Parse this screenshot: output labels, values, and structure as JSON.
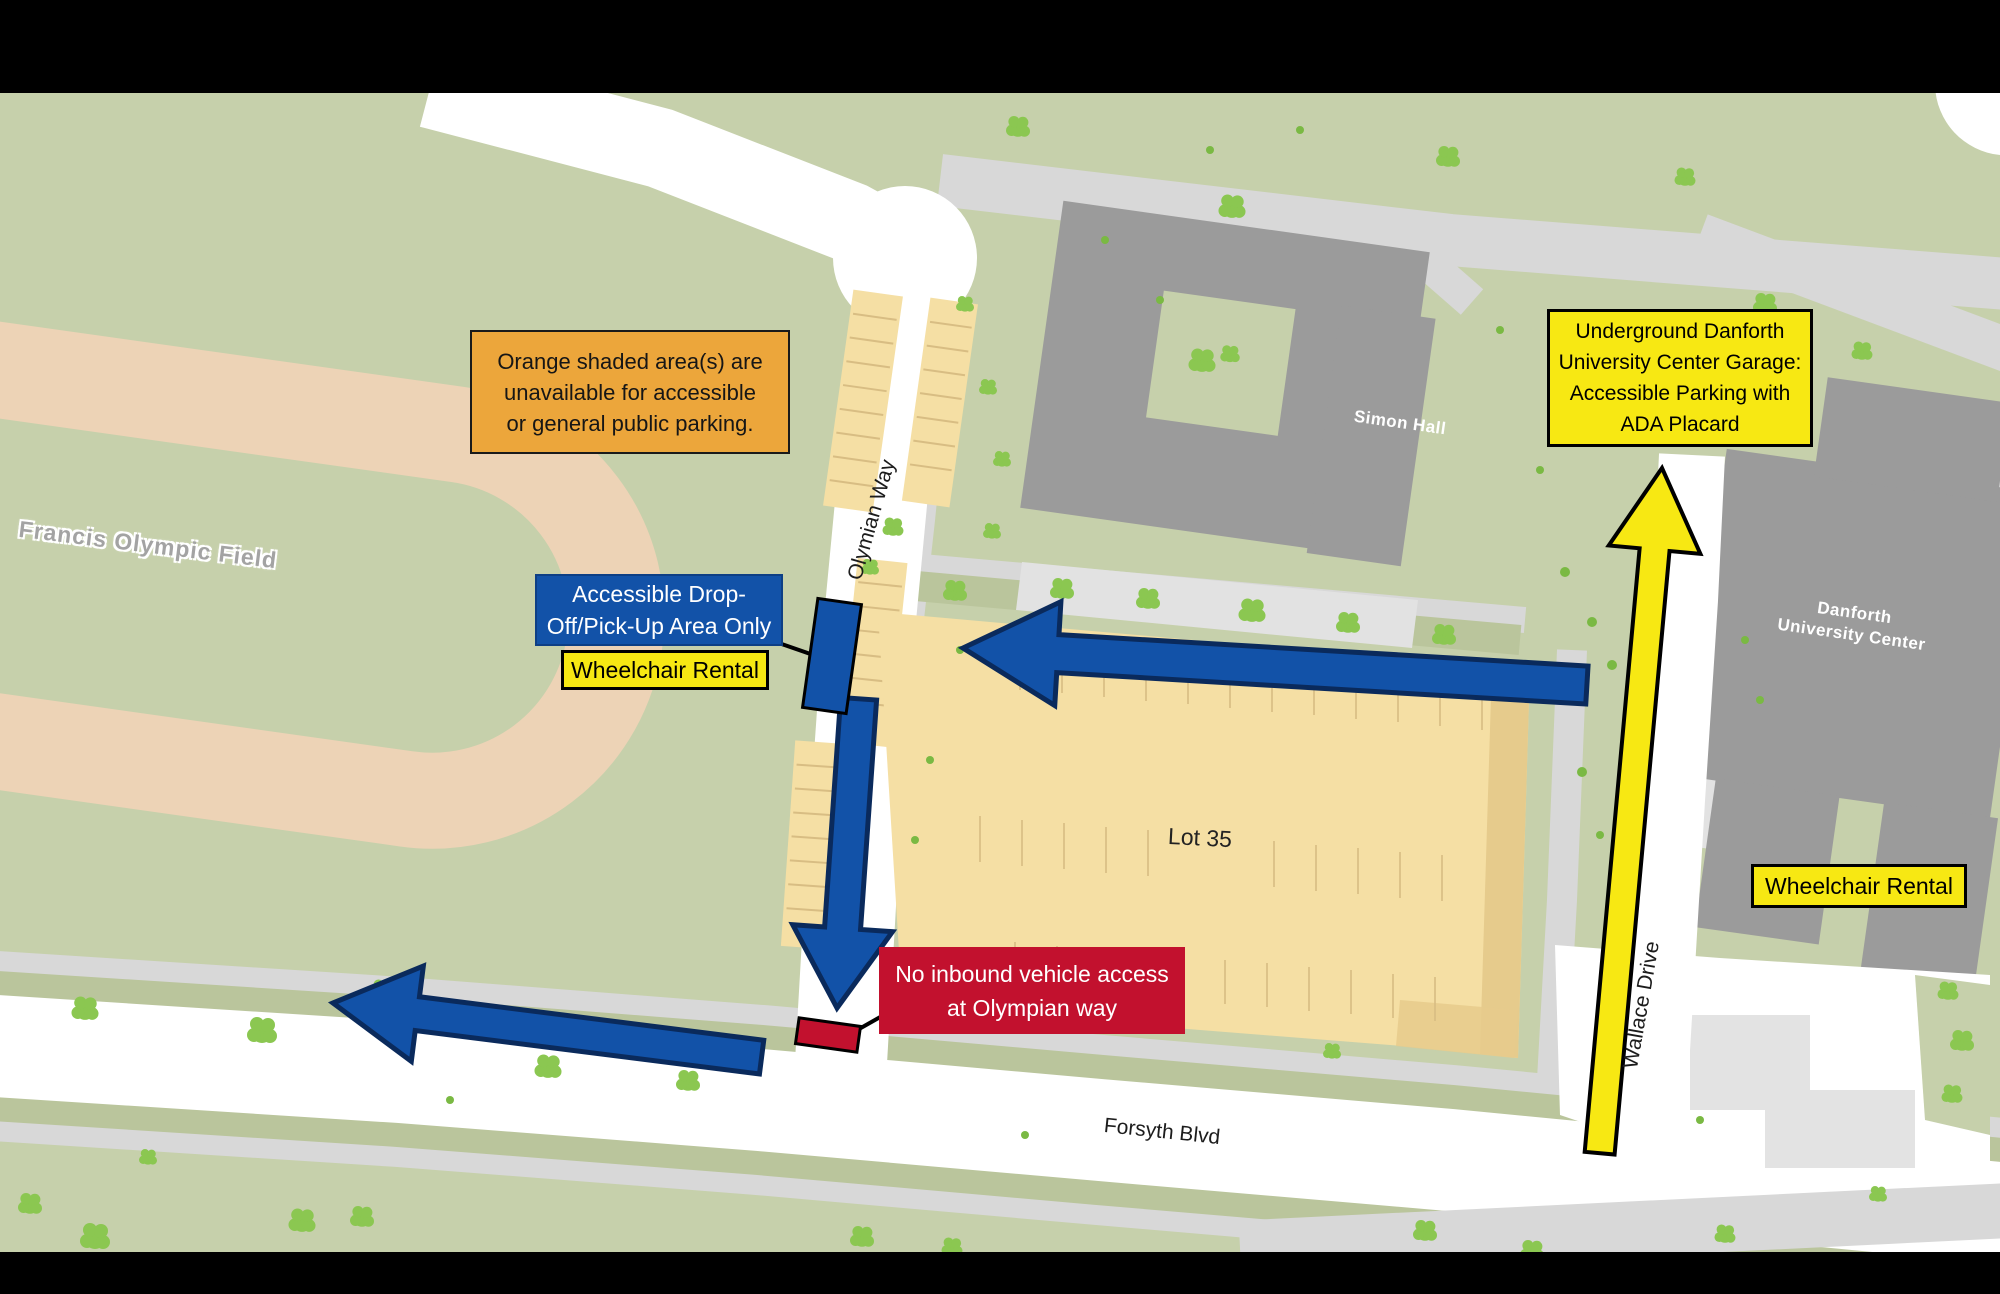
{
  "window": {
    "width_px": 2000,
    "height_px": 1294,
    "kind": "campus accessibility parking map"
  },
  "map_labels": {
    "field": "Francis Olympic Field",
    "simon_hall": "Simon Hall",
    "duc_line1": "Danforth",
    "duc_line2": "University Center",
    "olympian_way": "Olymian Way",
    "wallace_drive": "Wallace Drive",
    "forsyth_blvd": "Forsyth Blvd",
    "lot_35": "Lot 35"
  },
  "callouts": {
    "orange_note": {
      "lines": [
        "Orange shaded area(s) are",
        "unavailable for accessible",
        "or general public parking."
      ]
    },
    "dropoff": {
      "lines": [
        "Accessible Drop-",
        "Off/Pick-Up Area Only"
      ]
    },
    "wheelchair_west": {
      "label": "Wheelchair Rental"
    },
    "garage": {
      "lines": [
        "Underground Danforth",
        "University Center Garage:",
        "Accessible Parking with",
        "ADA Placard"
      ]
    },
    "no_inbound": {
      "lines": [
        "No inbound vehicle access",
        "at Olympian way"
      ]
    },
    "wheelchair_east": {
      "label": "Wheelchair Rental"
    }
  },
  "palette": {
    "letterbox_black": "#000000",
    "map_green": "#c6d0ab",
    "road_white": "#ffffff",
    "path_gray": "#d8d8d8",
    "plaza_gray": "#e2e2e2",
    "building_gray": "#9b9b9b",
    "building_light_gray": "#d9d9d9",
    "track_tan": "#edd3b6",
    "lot_orange": "#f5dfa4",
    "lot_stripe": "#d8bd83",
    "verge_green": "#bac59c",
    "tree_green": "#8bc751",
    "route_blue": "#1252a8",
    "route_blue_outline": "#0a2a5c",
    "highlight_yellow": "#f7e813",
    "note_orange": "#eca63b",
    "alert_red": "#c2112e"
  }
}
